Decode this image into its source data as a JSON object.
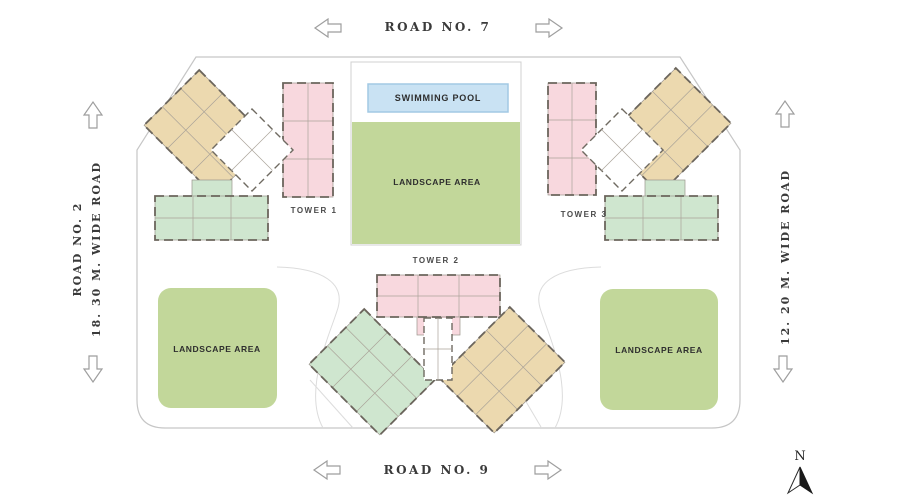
{
  "site_plan": {
    "roads": {
      "top": {
        "label": "ROAD NO. 7"
      },
      "bottom": {
        "label": "ROAD NO. 9"
      },
      "left": {
        "name": "ROAD NO. 2",
        "width_note": "18. 30 M. WIDE ROAD"
      },
      "right": {
        "width_note": "12. 20 M. WIDE ROAD"
      }
    },
    "towers": [
      {
        "label": "TOWER 1"
      },
      {
        "label": "TOWER 2"
      },
      {
        "label": "TOWER 3"
      }
    ],
    "amenities": {
      "swimming_pool": {
        "label": "SWIMMING POOL"
      },
      "landscape_center": {
        "label": "LANDSCAPE AREA"
      },
      "landscape_left": {
        "label": "LANDSCAPE AREA"
      },
      "landscape_right": {
        "label": "LANDSCAPE AREA"
      }
    },
    "compass": {
      "north": "N"
    },
    "colors": {
      "landscape_green": "#c2d79a",
      "pool_fill": "#c9e2f3",
      "pool_border": "#a2c9e4",
      "wing_tan": "#ecd9af",
      "wing_pink": "#f8d8de",
      "wing_mint": "#cfe6cf",
      "boundary_gray": "#c6c6c6",
      "wall_dark": "#6b655c"
    }
  }
}
